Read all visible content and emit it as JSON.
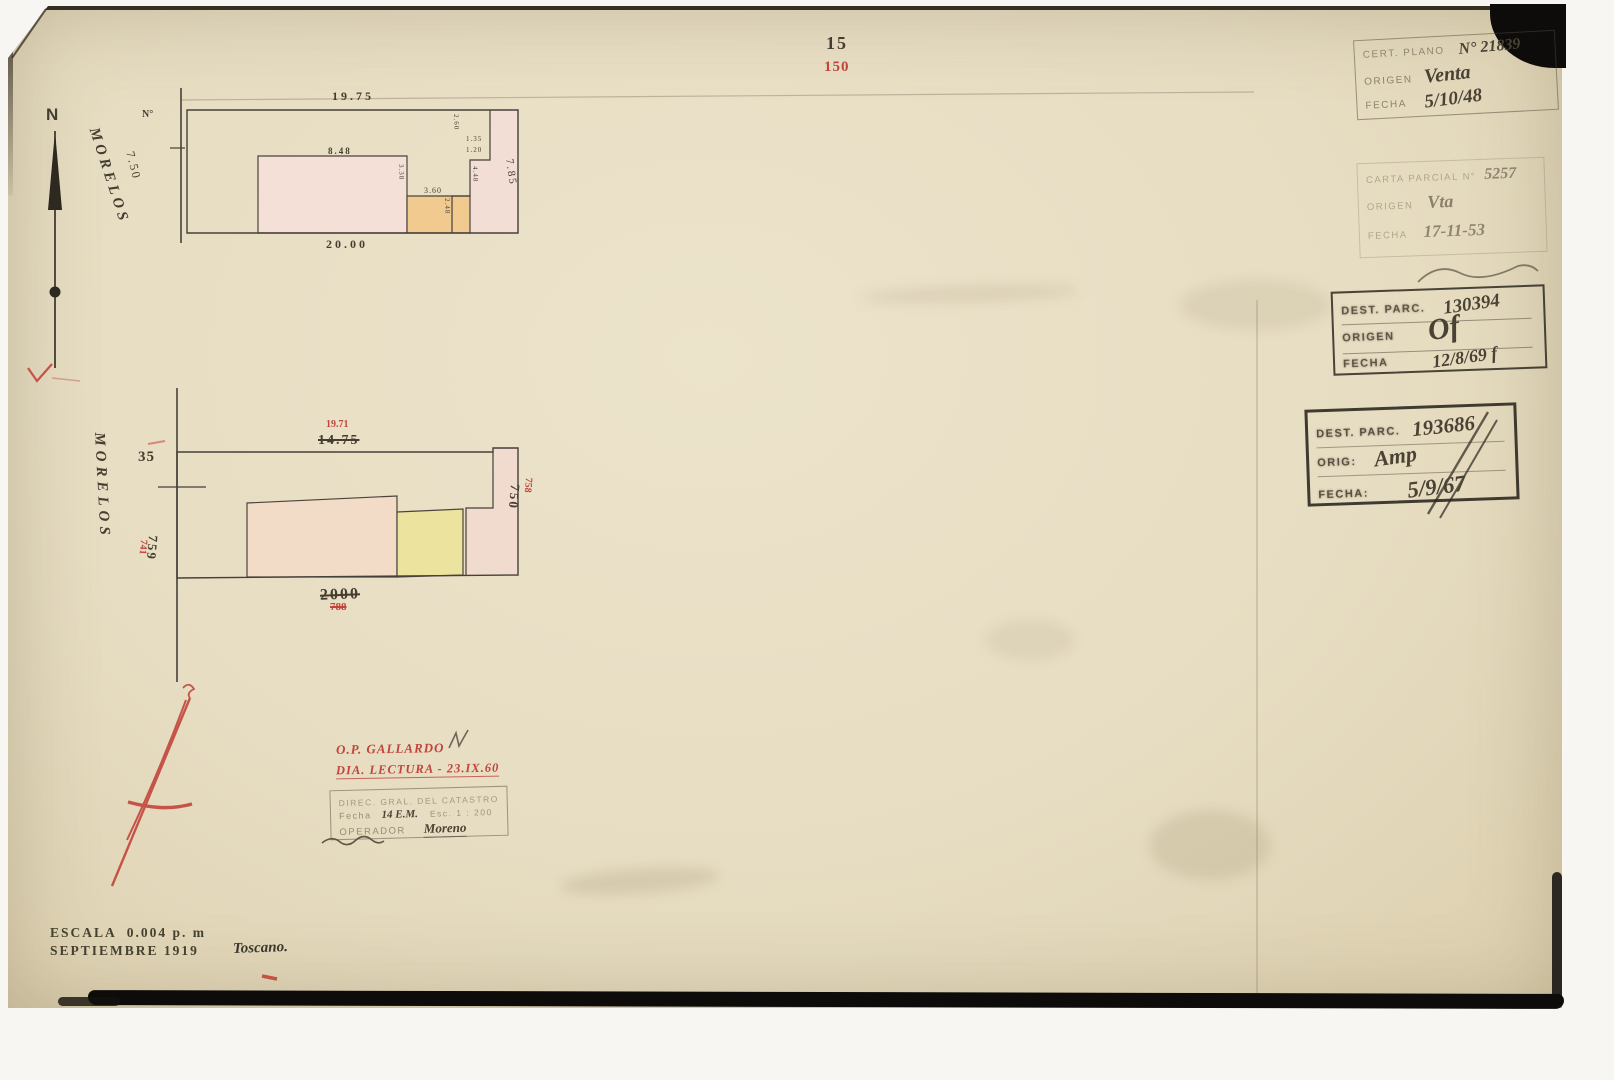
{
  "page": {
    "number_black": "15",
    "number_red": "150",
    "escala": "ESCALA  0.004 p. m",
    "fecha": "SEPTIEMBRE 1919",
    "firma": "Toscano.",
    "north": "N"
  },
  "upper_plan": {
    "street": "MORELOS",
    "lot": "N°",
    "front": "7.50",
    "top": "19.75",
    "bottom": "20.00",
    "right": "7.85",
    "building": "8.48",
    "dims": {
      "a": "2.60",
      "b": "1.35",
      "c": "1.20",
      "d": "4.48",
      "e": "3.38",
      "f": "3.60",
      "g": "2.48"
    }
  },
  "lower_plan": {
    "street": "MORELOS",
    "offset": "35",
    "top_black": "14.75",
    "top_red": "19.71",
    "bottom_black": "2000",
    "bottom_red": "788",
    "left_black": "759",
    "left_red": "741",
    "right_black": "750",
    "right_red": "758"
  },
  "red_note": {
    "line1": "O.P. GALLARDO",
    "line2": "DIA. LECTURA - 23.IX.60"
  },
  "operator_stamp": {
    "title": "DIREC. GRAL. DEL CATASTRO",
    "fecha_label": "Fecha",
    "fecha_value": "14 E.M.",
    "esc": "Esc. 1 : 200",
    "operador_label": "OPERADOR",
    "operador_value": "Moreno"
  },
  "stamps": {
    "cert": {
      "l1": "CERT. PLANO",
      "v1": "N° 21839",
      "l2": "ORIGEN",
      "v2": "Venta",
      "l3": "FECHA",
      "v3": "5/10/48"
    },
    "carta": {
      "l1": "CARTA PARCIAL N°",
      "v1": "5257",
      "l2": "ORIGEN",
      "v2": "Vta",
      "l3": "FECHA",
      "v3": "17-11-53"
    },
    "dest1": {
      "l1": "DEST. PARC.",
      "v1": "130394",
      "l2": "ORIGEN",
      "v2": "Of",
      "l3": "FECHA",
      "v3": "12/8/69 f"
    },
    "dest2": {
      "l1": "DEST. PARC.",
      "v1": "193686",
      "l2": "ORIG:",
      "v2": "Amp",
      "l3": "FECHA:",
      "v3": "5/9/67"
    }
  }
}
